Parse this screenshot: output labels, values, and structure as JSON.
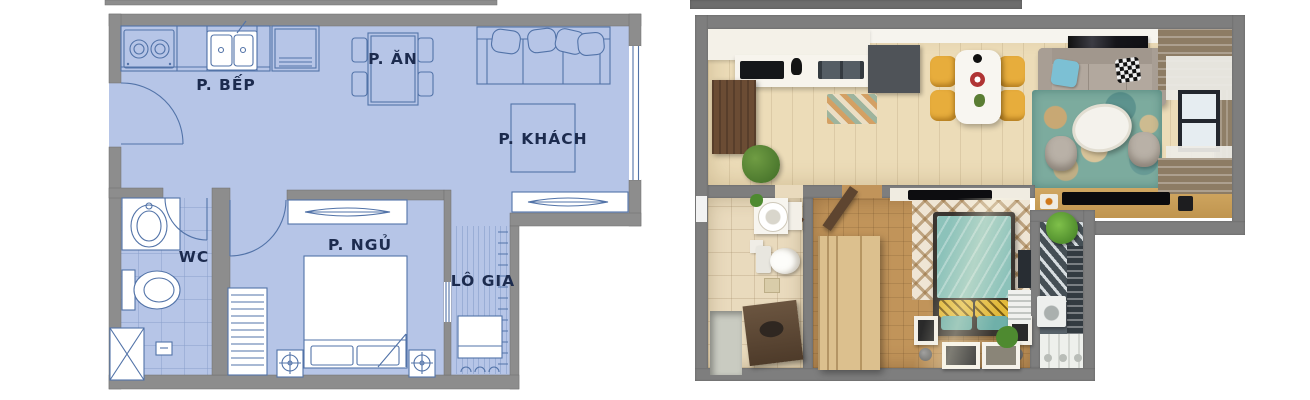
{
  "plan2d": {
    "rooms": {
      "kitchen": "P. BẾP",
      "dining": "P. ĂN",
      "living": "P. KHÁCH",
      "wc": "WC",
      "bedroom": "P. NGỦ",
      "loggia": "LÔ GIA"
    }
  },
  "colors": {
    "floor-blue": "#b6c5e7",
    "wall-gray": "#8d8d8d",
    "line-blue": "#5273a8",
    "label-navy": "#1c2b4e",
    "render-wall": "#7e7e7e",
    "beige-floor": "#ecdcb8",
    "wood-floor": "#c1945a",
    "teal-bed": "#8cc2ba",
    "yellow-chair": "#e7ad3c",
    "rug-teal": "#7cab9e",
    "curtain-brown": "#8d7c64"
  }
}
